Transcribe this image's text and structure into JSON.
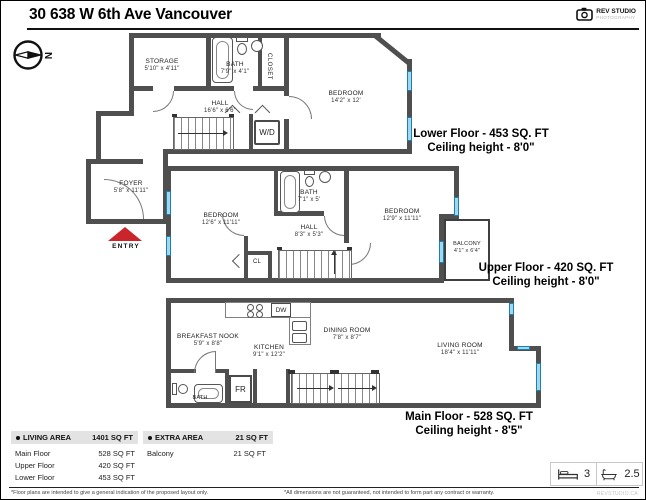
{
  "page": {
    "title": "30 638 W 6th Ave Vancouver"
  },
  "logo": {
    "name": "REV STUDIO",
    "sub": "PHOTOGRAPHY"
  },
  "compass": {
    "north": "N"
  },
  "rooms": {
    "storage": {
      "name": "STORAGE",
      "dims": "5'10\" x 4'11\""
    },
    "bath_lower": {
      "name": "BATH",
      "dims": "7'9\" x 4'1\""
    },
    "closet": "CLOSET",
    "bedroom_lower": {
      "name": "BEDROOM",
      "dims": "14'2\" x 12'"
    },
    "hall_lower": {
      "name": "HALL",
      "dims": "16'6\" x 6'6\""
    },
    "wd": "W/D",
    "foyer": {
      "name": "FOYER",
      "dims": "5'8\" x 11'11\""
    },
    "entry": "ENTRY",
    "bedroom_up_left": {
      "name": "BEDROOM",
      "dims": "12'6\" x 11'11\""
    },
    "bath_upper": {
      "name": "BATH",
      "dims": "7'1\" x 5'"
    },
    "hall_upper": {
      "name": "HALL",
      "dims": "8'3\" x 5'3\""
    },
    "bedroom_up_right": {
      "name": "BEDROOM",
      "dims": "12'9\" x 11'11\""
    },
    "cl": "CL",
    "balcony": {
      "name": "BALCONY",
      "dims": "4'1\" x 6'4\""
    },
    "breakfast_nook": {
      "name": "BREAKFAST NOOK",
      "dims": "5'9\" x 8'8\""
    },
    "kitchen": {
      "name": "KITCHEN",
      "dims": "9'1\" x 12'2\""
    },
    "dw": "DW",
    "dining": {
      "name": "DINING ROOM",
      "dims": "7'8\" x 8'7\""
    },
    "bath_main": "BATH",
    "fr": "FR",
    "living": {
      "name": "LIVING ROOM",
      "dims": "18'4\" x 11'11\""
    }
  },
  "floor_labels": {
    "lower": {
      "title": "Lower Floor - 453 SQ. FT",
      "ceiling": "Ceiling height - 8'0\""
    },
    "upper": {
      "title": "Upper Floor - 420 SQ. FT",
      "ceiling": "Ceiling height - 8'0\""
    },
    "main": {
      "title": "Main Floor - 528 SQ. FT",
      "ceiling": "Ceiling height - 8'5\""
    }
  },
  "summary": {
    "living": {
      "header": "LIVING AREA",
      "total": "1401 SQ FT",
      "rows": [
        {
          "label": "Main Floor",
          "value": "528 SQ FT"
        },
        {
          "label": "Upper Floor",
          "value": "420 SQ FT"
        },
        {
          "label": "Lower Floor",
          "value": "453 SQ FT"
        }
      ]
    },
    "extra": {
      "header": "EXTRA AREA",
      "total": "21 SQ FT",
      "rows": [
        {
          "label": "Balcony",
          "value": "21 SQ FT"
        }
      ]
    }
  },
  "stats": {
    "beds": "3",
    "baths": "2.5"
  },
  "footnotes": {
    "left": "*Floor plans are intended to give a general indication of the proposed layout only.",
    "right": "*All dimensions are not guaranteed, not intended to form part any contract or warranty.",
    "watermark": "REVSTUDIO.CA"
  },
  "colors": {
    "wall": "#4f4f4f",
    "window_fill": "#9fd8ef",
    "window_border": "#1d7fae",
    "entry_arrow": "#c9252b",
    "table_header_bg": "#e3e3e3"
  }
}
